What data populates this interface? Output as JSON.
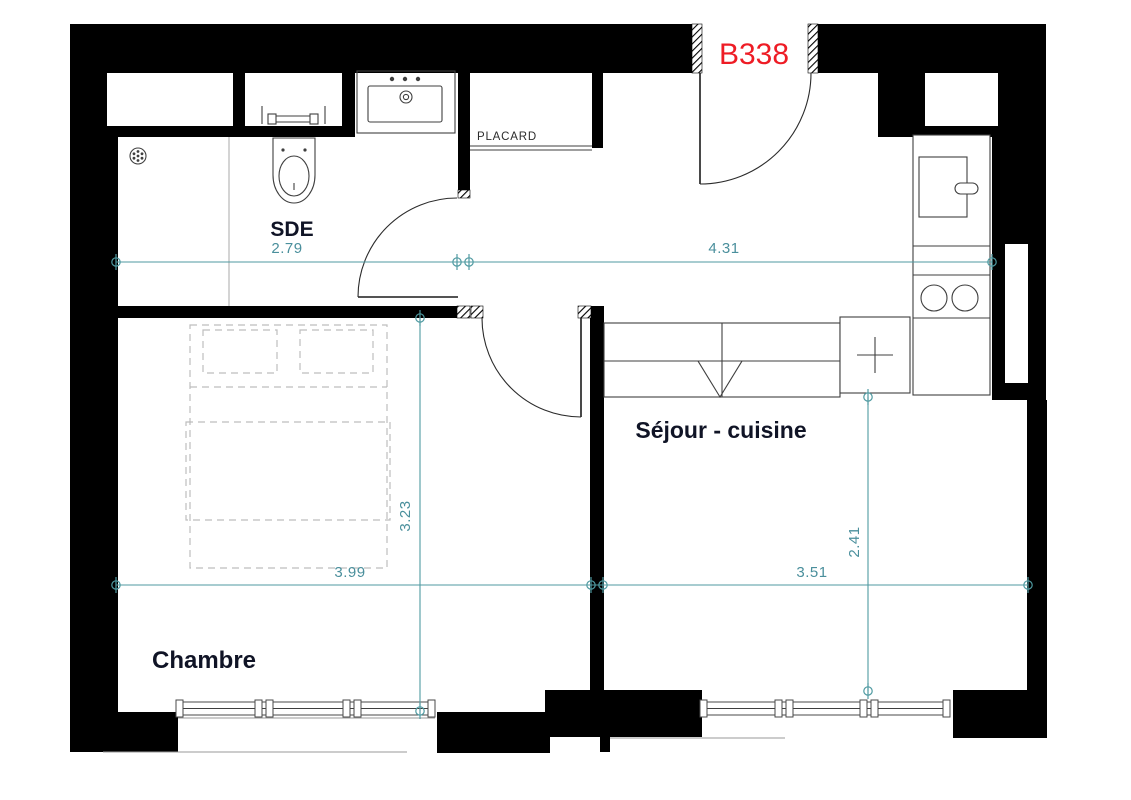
{
  "floorplan": {
    "unit": {
      "label": "B338",
      "color": "#ee1c25"
    },
    "rooms": {
      "sde": {
        "label": "SDE",
        "width_m": "2.79"
      },
      "placard": {
        "label": "PLACARD"
      },
      "entry": {
        "width_m": "4.31"
      },
      "chambre": {
        "label": "Chambre",
        "width_m": "3.99",
        "depth_m": "3.23"
      },
      "sejour": {
        "label": "Séjour - cuisine",
        "width_m": "3.51",
        "depth_m": "2.41"
      }
    },
    "colors": {
      "wall": "#000000",
      "dimension": "#4f9aa1",
      "room_label": "#101426",
      "fixture_line": "#3f3f3f",
      "bed_dash": "#bdbdbd",
      "unit_label": "#ee1c25"
    }
  }
}
